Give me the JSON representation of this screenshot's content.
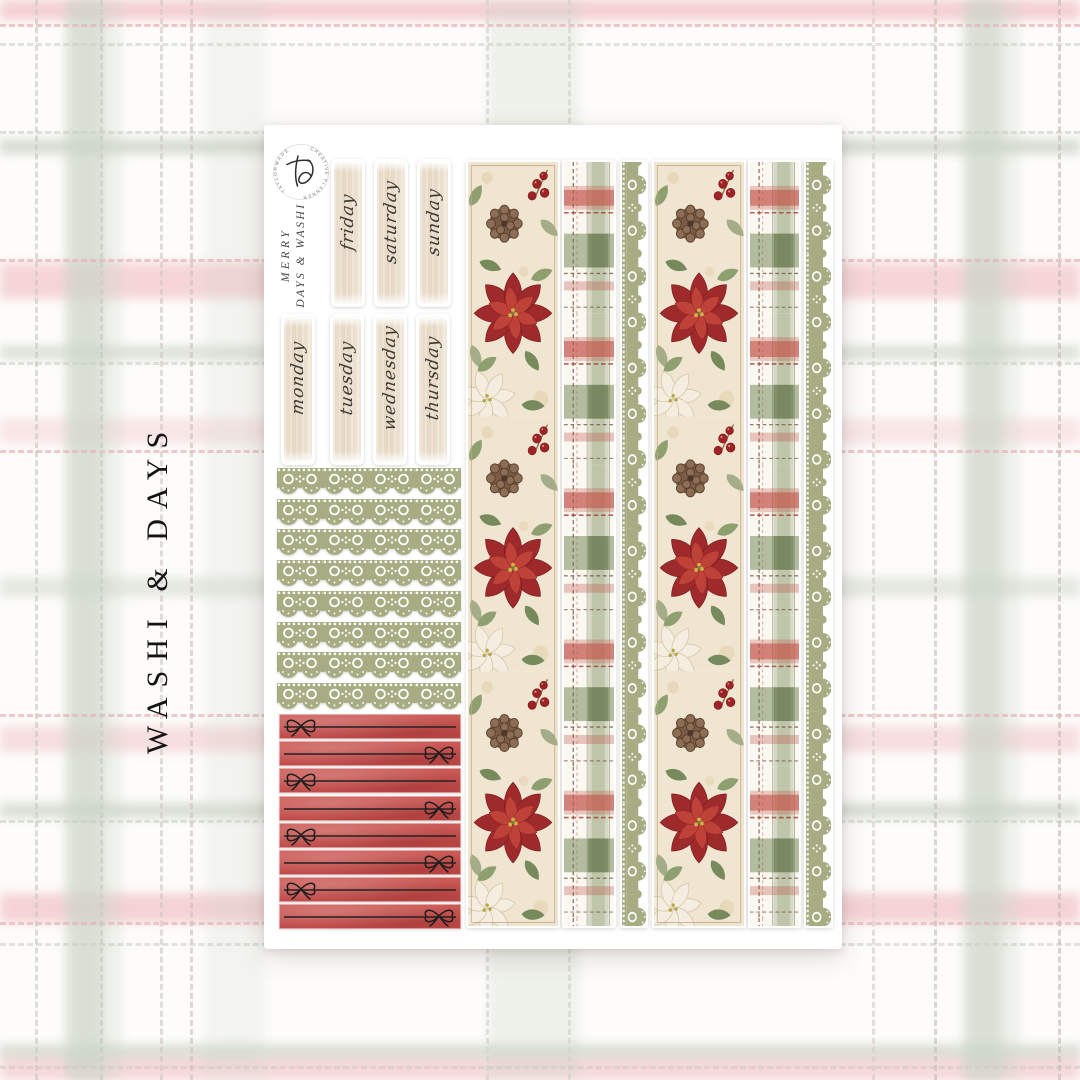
{
  "side_title": "WASHI & DAYS",
  "sheet": {
    "logo": {
      "arc_left": "TAYLORMADE",
      "arc_right": "CREATIVE PLANNER"
    },
    "brand": {
      "line1": "MERRY",
      "line2": "DAYS & WASHI"
    },
    "day_stickers": {
      "row1": [
        "friday",
        "saturday",
        "sunday"
      ],
      "row2": [
        "monday",
        "tuesday",
        "wednesday",
        "thursday"
      ]
    },
    "lace_border_stickers": {
      "count": 8,
      "style": "green-lace-trim"
    },
    "red_line_stickers": {
      "count": 8,
      "style": "red-watercolor-bow-line",
      "bow_sides": [
        "left",
        "right",
        "left",
        "right",
        "left",
        "right",
        "left",
        "right"
      ]
    },
    "washi_strips": {
      "groups": 2,
      "columns": [
        "poinsettia-floral",
        "christmas-plaid",
        "green-lace"
      ]
    }
  },
  "colors": {
    "background": "#fdfcfa",
    "plaid_pink": "#f2c5c9",
    "plaid_sage": "#ccd5c8",
    "stitch_pink": "#e6b4b8",
    "stitch_gray": "#c9cdc3",
    "sheet": "#ffffff",
    "brush_cream": "#e8dbc6",
    "lace_green": "#a7ac83",
    "strip_red": "#c75551",
    "poinsettia_red": "#9e2a2c",
    "holly_green": "#8fa070",
    "title_text": "#141414"
  }
}
